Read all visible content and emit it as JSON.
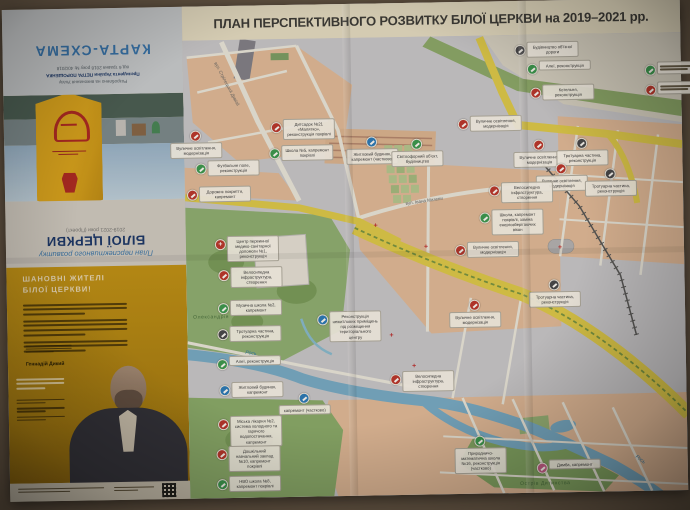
{
  "colors": {
    "background_table": "#6b5c4b",
    "paper": "#dfdacb",
    "panel_yellow": "#c49616",
    "karta_blue": "#3a78b5",
    "city_blue": "#1e3a6e",
    "map_base": "#cccdd4",
    "residential_peach": "#e5c0a0",
    "park_green": "#8fb074",
    "water_blue": "#7ab0cf",
    "road_yellow": "#e2cf4e"
  },
  "left_panel": {
    "karta_schema": "КАРТА-СХЕМА",
    "decree_lines": [
      "Розроблено на виконання Указу",
      "Президента України ПЕТРА ПОРОШЕНКА",
      "від 6 травня 2018 року № 40/2018"
    ],
    "plan_line": "План перспективного розвитку",
    "city": "БІЛОЇ ЦЕРКВИ",
    "years_line": "2019-2021 роки (Проект)",
    "greeting_line1": "ШАНОВНІ ЖИТЕЛІ",
    "greeting_line2": "БІЛОЇ ЦЕРКВИ!",
    "signature": "Геннадій Дикий"
  },
  "map": {
    "title": "ПЛАН ПЕРСПЕКТИВНОГО РОЗВИТКУ БІЛОЇ ЦЕРКВИ на 2019–2021 рр.",
    "marker_colors": {
      "red": "#bf3a2f",
      "green": "#3f9e53",
      "blue": "#2f7fc1",
      "dark": "#4b4b4f",
      "pink": "#c9628f"
    },
    "markers": [
      {
        "x": 186,
        "y": 124,
        "c": "red",
        "s": "below",
        "t": "Вуличне освітлення, модернізація"
      },
      {
        "x": 267,
        "y": 117,
        "c": "red",
        "s": "right",
        "t": "Дитсадок №21 «Малятко», реконструкція покрівлі"
      },
      {
        "x": 265,
        "y": 143,
        "c": "green",
        "s": "right",
        "t": "Школа №5, капремонт покрівлі"
      },
      {
        "x": 191,
        "y": 157,
        "c": "green",
        "s": "right",
        "t": "Футбольне поле, реконструкція"
      },
      {
        "x": 182,
        "y": 183,
        "c": "red",
        "s": "right",
        "t": "Дорожнє покриття, капремонт"
      },
      {
        "x": 362,
        "y": 133,
        "c": "blue",
        "s": "below",
        "t": "Житловий будинок, капремонт (частково)"
      },
      {
        "x": 407,
        "y": 136,
        "c": "green",
        "s": "below",
        "t": "Світлофорний об'єкт, будівництво"
      },
      {
        "x": 454,
        "y": 117,
        "c": "red",
        "s": "right",
        "t": "Вуличне освітлення, модернізація"
      },
      {
        "x": 512,
        "y": 44,
        "c": "dark",
        "s": "right",
        "t": "Будівництво об'їзної дороги"
      },
      {
        "x": 524,
        "y": 63,
        "c": "green",
        "s": "right",
        "t": "Алеї, реконструкція"
      },
      {
        "x": 527,
        "y": 87,
        "c": "red",
        "s": "right",
        "t": "Котельня, реконструкція"
      },
      {
        "x": 529,
        "y": 139,
        "c": "red",
        "s": "below",
        "t": "Вуличне освітлення, модернізація"
      },
      {
        "x": 572,
        "y": 138,
        "c": "dark",
        "s": "below",
        "t": "Тротуарна частина, реконструкція"
      },
      {
        "x": 551,
        "y": 163,
        "c": "red",
        "s": "below",
        "t": "Вуличне освітлення, модернізація"
      },
      {
        "x": 600,
        "y": 169,
        "c": "dark",
        "s": "below",
        "t": "Тротуарна частина, реконструкція"
      },
      {
        "x": 209,
        "y": 233,
        "c": "red",
        "i": "plus",
        "s": "right",
        "t": "Центр первинної медико-санітарної допомоги №1, реконструкція"
      },
      {
        "x": 212,
        "y": 264,
        "c": "red",
        "s": "right",
        "t": "Велосипедна інфраструктура, створення"
      },
      {
        "x": 484,
        "y": 184,
        "c": "red",
        "s": "right",
        "t": "Велосипедна інфраструктура, створення"
      },
      {
        "x": 474,
        "y": 211,
        "c": "green",
        "s": "right",
        "t": "Школа, капремонт покрівлі, заміна енергозберігаючих вікон"
      },
      {
        "x": 449,
        "y": 243,
        "c": "red",
        "s": "right",
        "t": "Вуличне освітлення, модернізація"
      },
      {
        "x": 211,
        "y": 297,
        "c": "green",
        "s": "right",
        "t": "Музична школа №2, капремонт"
      },
      {
        "x": 210,
        "y": 323,
        "c": "dark",
        "s": "right",
        "t": "Тротуарна частина, реконструкція"
      },
      {
        "x": 209,
        "y": 353,
        "c": "green",
        "s": "right",
        "t": "Алеї, реконструкція"
      },
      {
        "x": 211,
        "y": 379,
        "c": "blue",
        "s": "right",
        "t": "Житловий будинок, капремонт"
      },
      {
        "x": 310,
        "y": 310,
        "c": "blue",
        "s": "right",
        "t": "Реконструкція нежитлових приміщень під розміщення територіального центру"
      },
      {
        "x": 462,
        "y": 298,
        "c": "red",
        "s": "below",
        "t": "Вуличне освітлення, модернізація"
      },
      {
        "x": 382,
        "y": 371,
        "c": "red",
        "s": "right",
        "t": "Велосипедна інфраструктура, створення"
      },
      {
        "x": 542,
        "y": 279,
        "c": "dark",
        "s": "below",
        "t": "Тротуарна частина, реконструкція"
      },
      {
        "x": 209,
        "y": 413,
        "c": "red",
        "s": "right",
        "t": "Міська лікарня №2, система холодного та гарячого водопостачання, капремонт"
      },
      {
        "x": 207,
        "y": 443,
        "c": "red",
        "s": "right",
        "t": "Дошкільний навчальний заклад №10, капремонт покрівлі"
      },
      {
        "x": 207,
        "y": 473,
        "c": "green",
        "s": "right",
        "t": "НВО школа №8, капремонт покрівлі"
      },
      {
        "x": 465,
        "y": 434,
        "c": "green",
        "s": "below",
        "t": "Природничо-математична школа №16, реконструкція (частково)"
      },
      {
        "x": 527,
        "y": 462,
        "c": "pink",
        "s": "right",
        "t": "Дамба, капремонт"
      },
      {
        "x": 290,
        "y": 388,
        "c": "blue",
        "s": "below",
        "t": "капремонт (частково)"
      },
      {
        "x": 642,
        "y": 66,
        "c": "green",
        "s": "right",
        "t": ""
      },
      {
        "x": 642,
        "y": 86,
        "c": "red",
        "s": "right",
        "t": ""
      }
    ],
    "street_labels": [
      {
        "x": 215,
        "y": 55,
        "rot": 63,
        "cls": "st",
        "t": "вул. Стрілецької Дивізії"
      },
      {
        "x": 400,
        "y": 198,
        "rot": -7,
        "cls": "st",
        "t": "вул. Івана Мазепи"
      },
      {
        "x": 238,
        "y": 344,
        "rot": 8,
        "cls": "river",
        "t": "Рось"
      },
      {
        "x": 628,
        "y": 455,
        "rot": 38,
        "cls": "river",
        "t": "Рось"
      },
      {
        "x": 510,
        "y": 480,
        "rot": 0,
        "cls": "parkname",
        "t": "Острів Дитинства"
      },
      {
        "x": 186,
        "y": 308,
        "rot": 0,
        "cls": "parkname",
        "t": "Олександрія"
      }
    ]
  }
}
